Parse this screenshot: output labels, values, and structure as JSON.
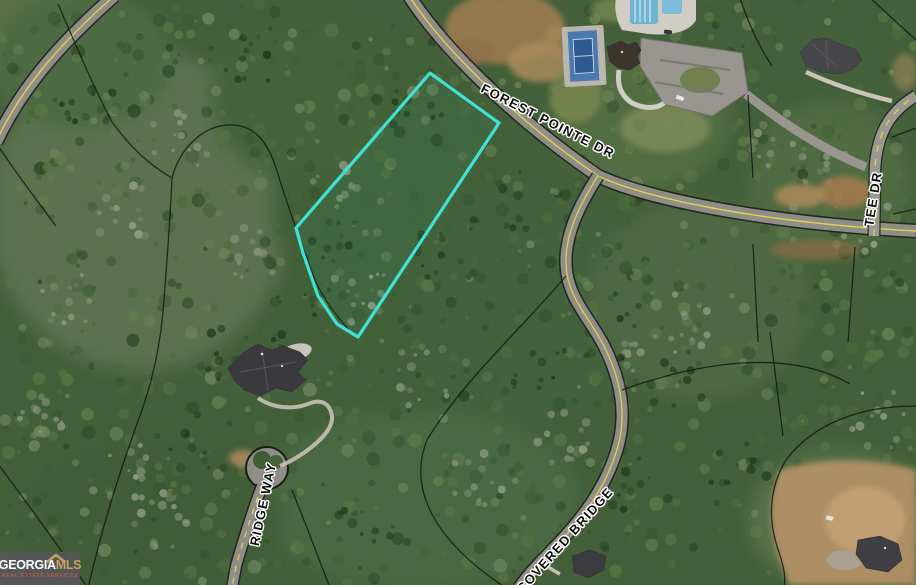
{
  "map": {
    "streets": [
      {
        "id": "forest-pointe-dr",
        "label": "FOREST POINTE DR"
      },
      {
        "id": "tee-dr",
        "label": "TEE DR"
      },
      {
        "id": "covered-bridge",
        "label": "COVERED BRIDGE"
      },
      {
        "id": "ridge-way",
        "label": "RIDGE WAY"
      }
    ]
  },
  "watermark": {
    "brand": "GEORGIA",
    "brand_suffix": "MLS",
    "tagline": "REAL ESTATE SERVICES"
  },
  "colors": {
    "lot_outline": "#3FE3D6",
    "road_centerline": "#E3CF52",
    "logo_gold": "#C9A25F",
    "logo_tagline": "#C05548"
  }
}
